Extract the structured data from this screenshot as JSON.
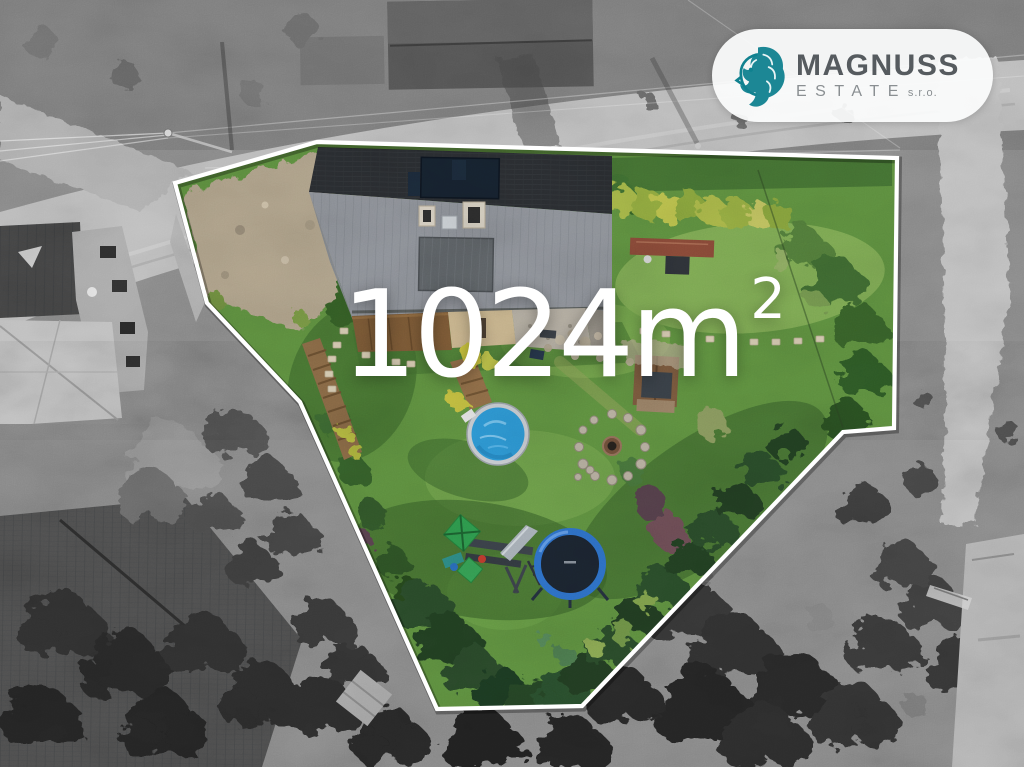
{
  "watermark": {
    "area_value": "1024m",
    "area_exponent": "2"
  },
  "logo": {
    "brand": "MAGNUSS",
    "division": "ESTATE",
    "suffix": "s.r.o."
  },
  "colors": {
    "brand_teal": "#10818f",
    "logo_brand": "#565b5f",
    "logo_sub": "#8a8f92",
    "overlay_text": "#ffffff",
    "boundary_white": "#ffffff",
    "lawn_green": "#5f9140",
    "pool_blue": "#2d98d4",
    "trampoline_ring": "#2e71c8",
    "roof_dark": "#2a2d31",
    "roof_light": "#8f939a",
    "gravel_tan": "#b1a48c"
  }
}
